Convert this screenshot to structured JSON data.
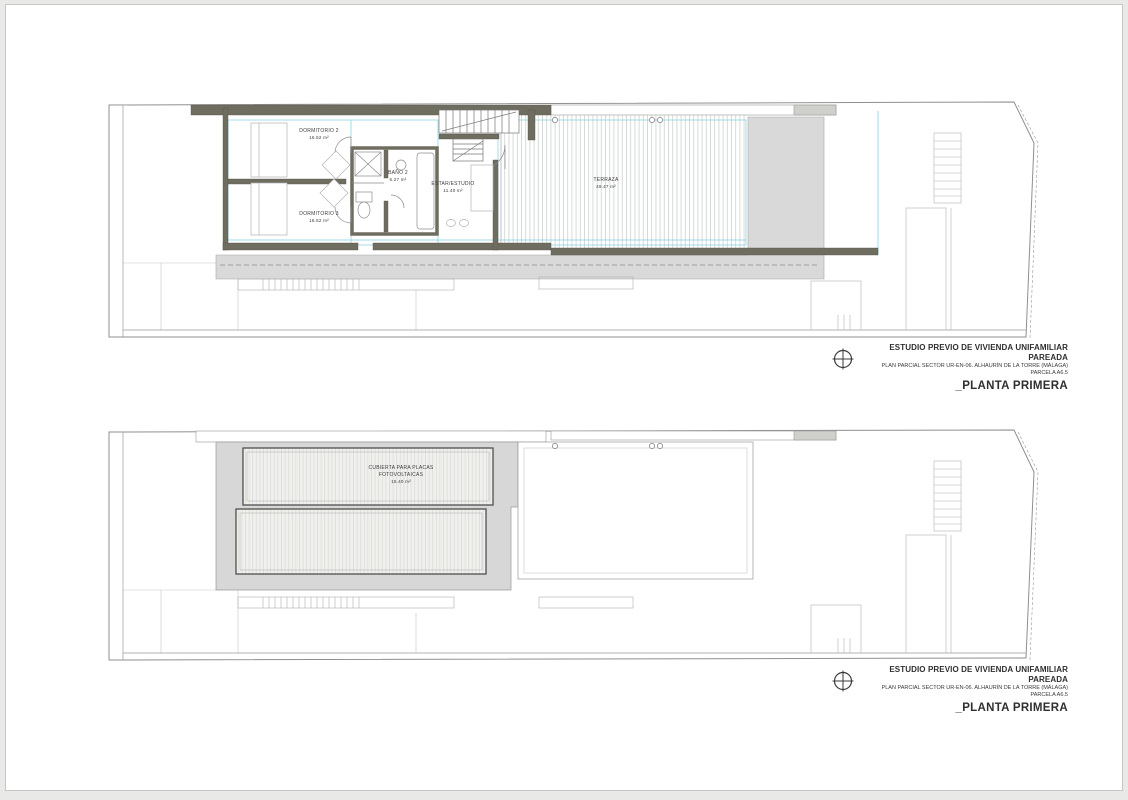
{
  "document": {
    "sheet_title": "ESTUDIO PREVIO DE VIVIENDA UNIFAMILIAR PAREADA",
    "sheet_subtitle": "PLAN PARCIAL SECTOR UR-EN-06. ALHAURÍN DE LA TORRE (MÁLAGA)",
    "parcel": "PARCELA A6.5",
    "plan_name": "_PLANTA PRIMERA"
  },
  "upper_plan": {
    "rooms": {
      "dormitorio2": {
        "name": "DORMITORIO 2",
        "area": "16.52 m²"
      },
      "dormitorio3": {
        "name": "DORMITORIO 3",
        "area": "16.52 m²"
      },
      "bano2": {
        "name": "BAÑO 2",
        "area": "5.27 m²"
      },
      "estar_estudio": {
        "name": "ESTAR/ESTUDIO",
        "area": "11.40 m²"
      },
      "terraza": {
        "name": "TERRAZA",
        "area": "49.47 m²"
      }
    }
  },
  "lower_plan": {
    "roof_label": {
      "line1": "CUBIERTA PARA PLACAS",
      "line2": "FOTOVOLTAICAS",
      "area": "15.40 m²"
    }
  },
  "colors": {
    "wall": "#6e6d5f",
    "paving_band": "#d9d9d9",
    "roof_slab": "#d7d7d7",
    "panel_fill": "#f0f0ee",
    "dimension_cyan": "#7fd0e0",
    "thin_line": "#9a9a9a"
  }
}
